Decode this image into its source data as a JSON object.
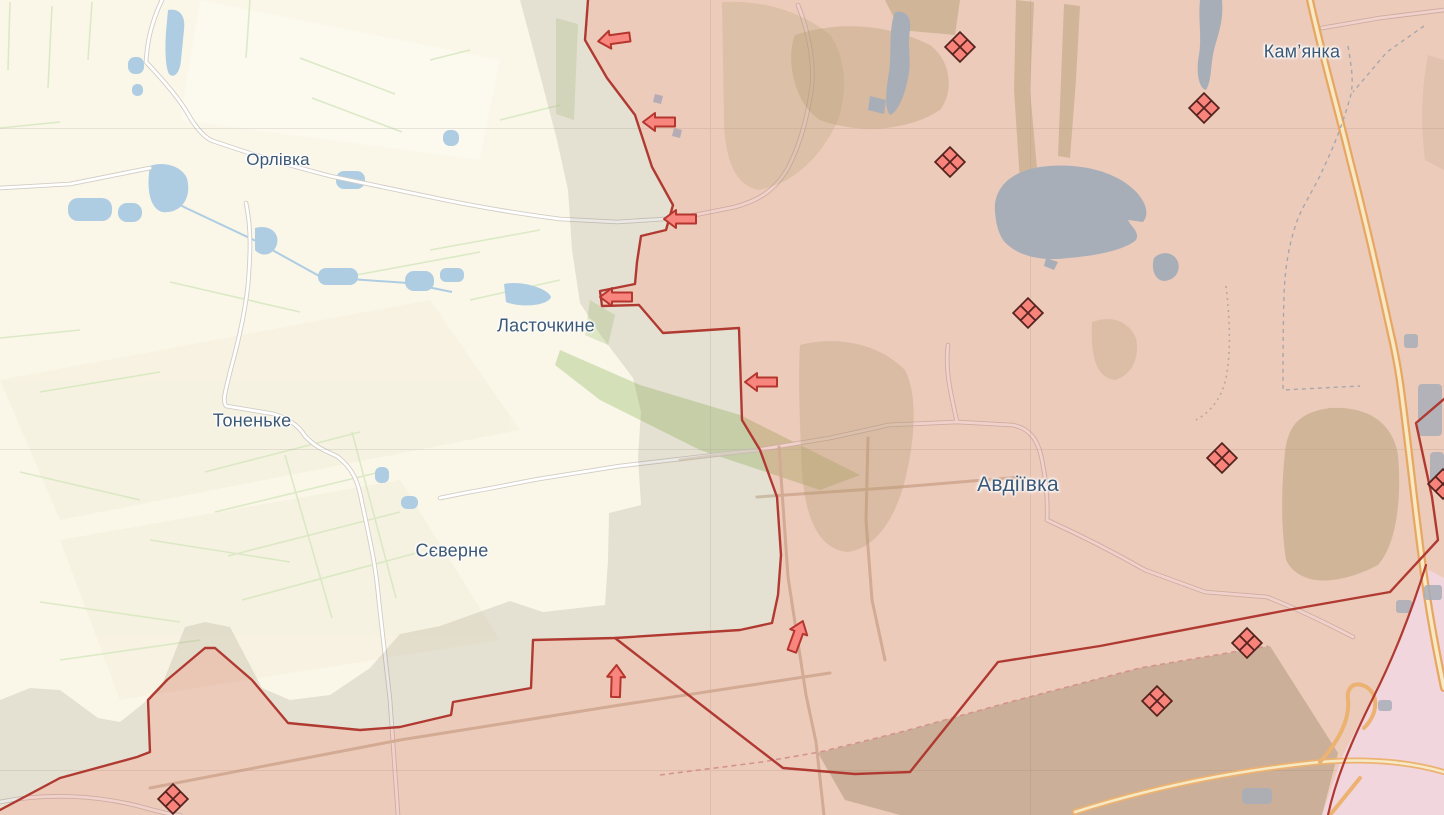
{
  "map": {
    "settlements": [
      {
        "id": "orlivka",
        "text": "Орлівка",
        "x": 278,
        "y": 160,
        "size": 17
      },
      {
        "id": "lastochkyne",
        "text": "Ласточкине",
        "x": 546,
        "y": 326,
        "size": 18
      },
      {
        "id": "tonenke",
        "text": "Тоненьке",
        "x": 252,
        "y": 421,
        "size": 18
      },
      {
        "id": "sieverne",
        "text": "Сєверне",
        "x": 452,
        "y": 551,
        "size": 18
      },
      {
        "id": "avdiivka",
        "text": "Авдіївка",
        "x": 1018,
        "y": 485,
        "size": 21
      },
      {
        "id": "kamianka",
        "text": "Кам’янка",
        "x": 1302,
        "y": 52,
        "size": 18
      }
    ],
    "clash_markers": [
      {
        "x": 960,
        "y": 47
      },
      {
        "x": 950,
        "y": 162
      },
      {
        "x": 1204,
        "y": 108
      },
      {
        "x": 1028,
        "y": 313
      },
      {
        "x": 1222,
        "y": 458
      },
      {
        "x": 1247,
        "y": 643
      },
      {
        "x": 1157,
        "y": 701
      },
      {
        "x": 173,
        "y": 799
      },
      {
        "x": 1443,
        "y": 484
      }
    ],
    "attack_arrows": [
      {
        "x": 615,
        "y": 39,
        "rot": -8
      },
      {
        "x": 660,
        "y": 122,
        "rot": 0
      },
      {
        "x": 681,
        "y": 219,
        "rot": 0
      },
      {
        "x": 617,
        "y": 297,
        "rot": 0
      },
      {
        "x": 762,
        "y": 382,
        "rot": 0
      },
      {
        "x": 616,
        "y": 682,
        "rot": 92
      },
      {
        "x": 797,
        "y": 637,
        "rot": 110
      }
    ],
    "colors": {
      "free_area": "#faf7e9",
      "occupied_overlay": "rgba(199,84,64,0.27)",
      "grey_zone_overlay": "rgba(125,110,95,0.16)",
      "front_line": "#b03a31",
      "clash_fill": "#f8837b",
      "clash_stroke": "#55241f",
      "arrow_fill": "#f9867e",
      "arrow_stroke": "#b5362e",
      "water_blue": "#aecde3",
      "water_grey": "#a8aeb8",
      "label_color": "#3b5877",
      "highway_orange": "#e7a763"
    }
  }
}
